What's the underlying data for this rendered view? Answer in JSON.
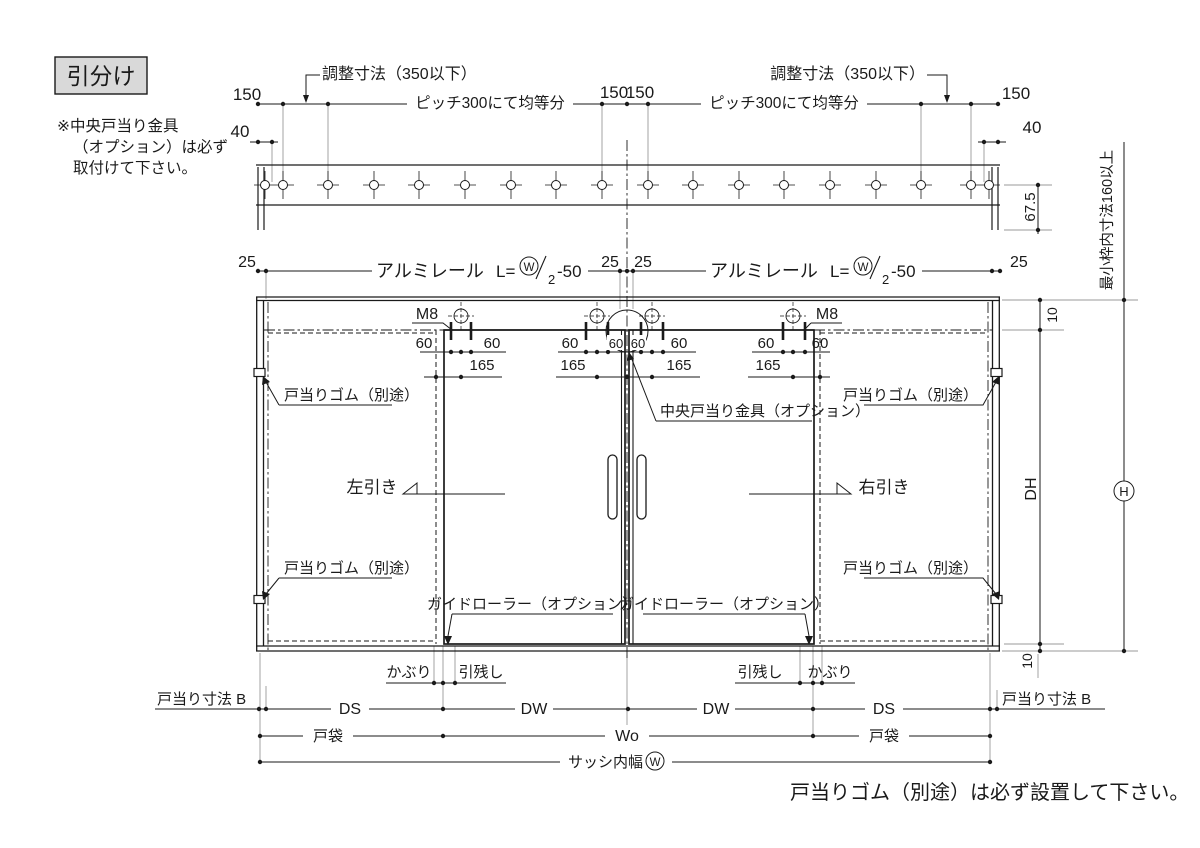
{
  "title": "引分け",
  "side_note": {
    "line1": "※中央戸当り金具",
    "line2": "（オプション）は必ず",
    "line3": "取付けて下さい。"
  },
  "bottom_note": "戸当りゴム（別途）は必ず設置して下さい。",
  "ann": {
    "adjust": "調整寸法（350以下）",
    "pitch": "ピッチ300にて均等分",
    "alumi": "アルミレール",
    "l_eq": "L=",
    "w": "W",
    "den": "2",
    "suffix": "-50",
    "center_stop": "中央戸当り金具（オプション）",
    "rubber": "戸当りゴム（別途）",
    "guide": "ガイドローラー（オプション）",
    "slide_left": "左引き",
    "slide_right": "右引き",
    "kaburi": "かぶり",
    "hikinokoshi": "引残し",
    "stop_b": "戸当り寸法 B",
    "min_frame": "最小枠内寸法160以上",
    "sash_width": "サッシ内幅",
    "pocket": "戸袋"
  },
  "dims": {
    "d150": "150",
    "d40": "40",
    "d67_5": "67.5",
    "d25": "25",
    "d10": "10",
    "d60": "60",
    "d165": "165",
    "m8": "M8",
    "dh": "DH",
    "h": "H",
    "w": "W",
    "wo": "Wo",
    "ds": "DS",
    "dw": "DW"
  },
  "colors": {
    "line": "#1a1a1a",
    "ext_line": "#9a9a9a",
    "title_bg": "#d9d9d9",
    "bg": "#ffffff"
  }
}
